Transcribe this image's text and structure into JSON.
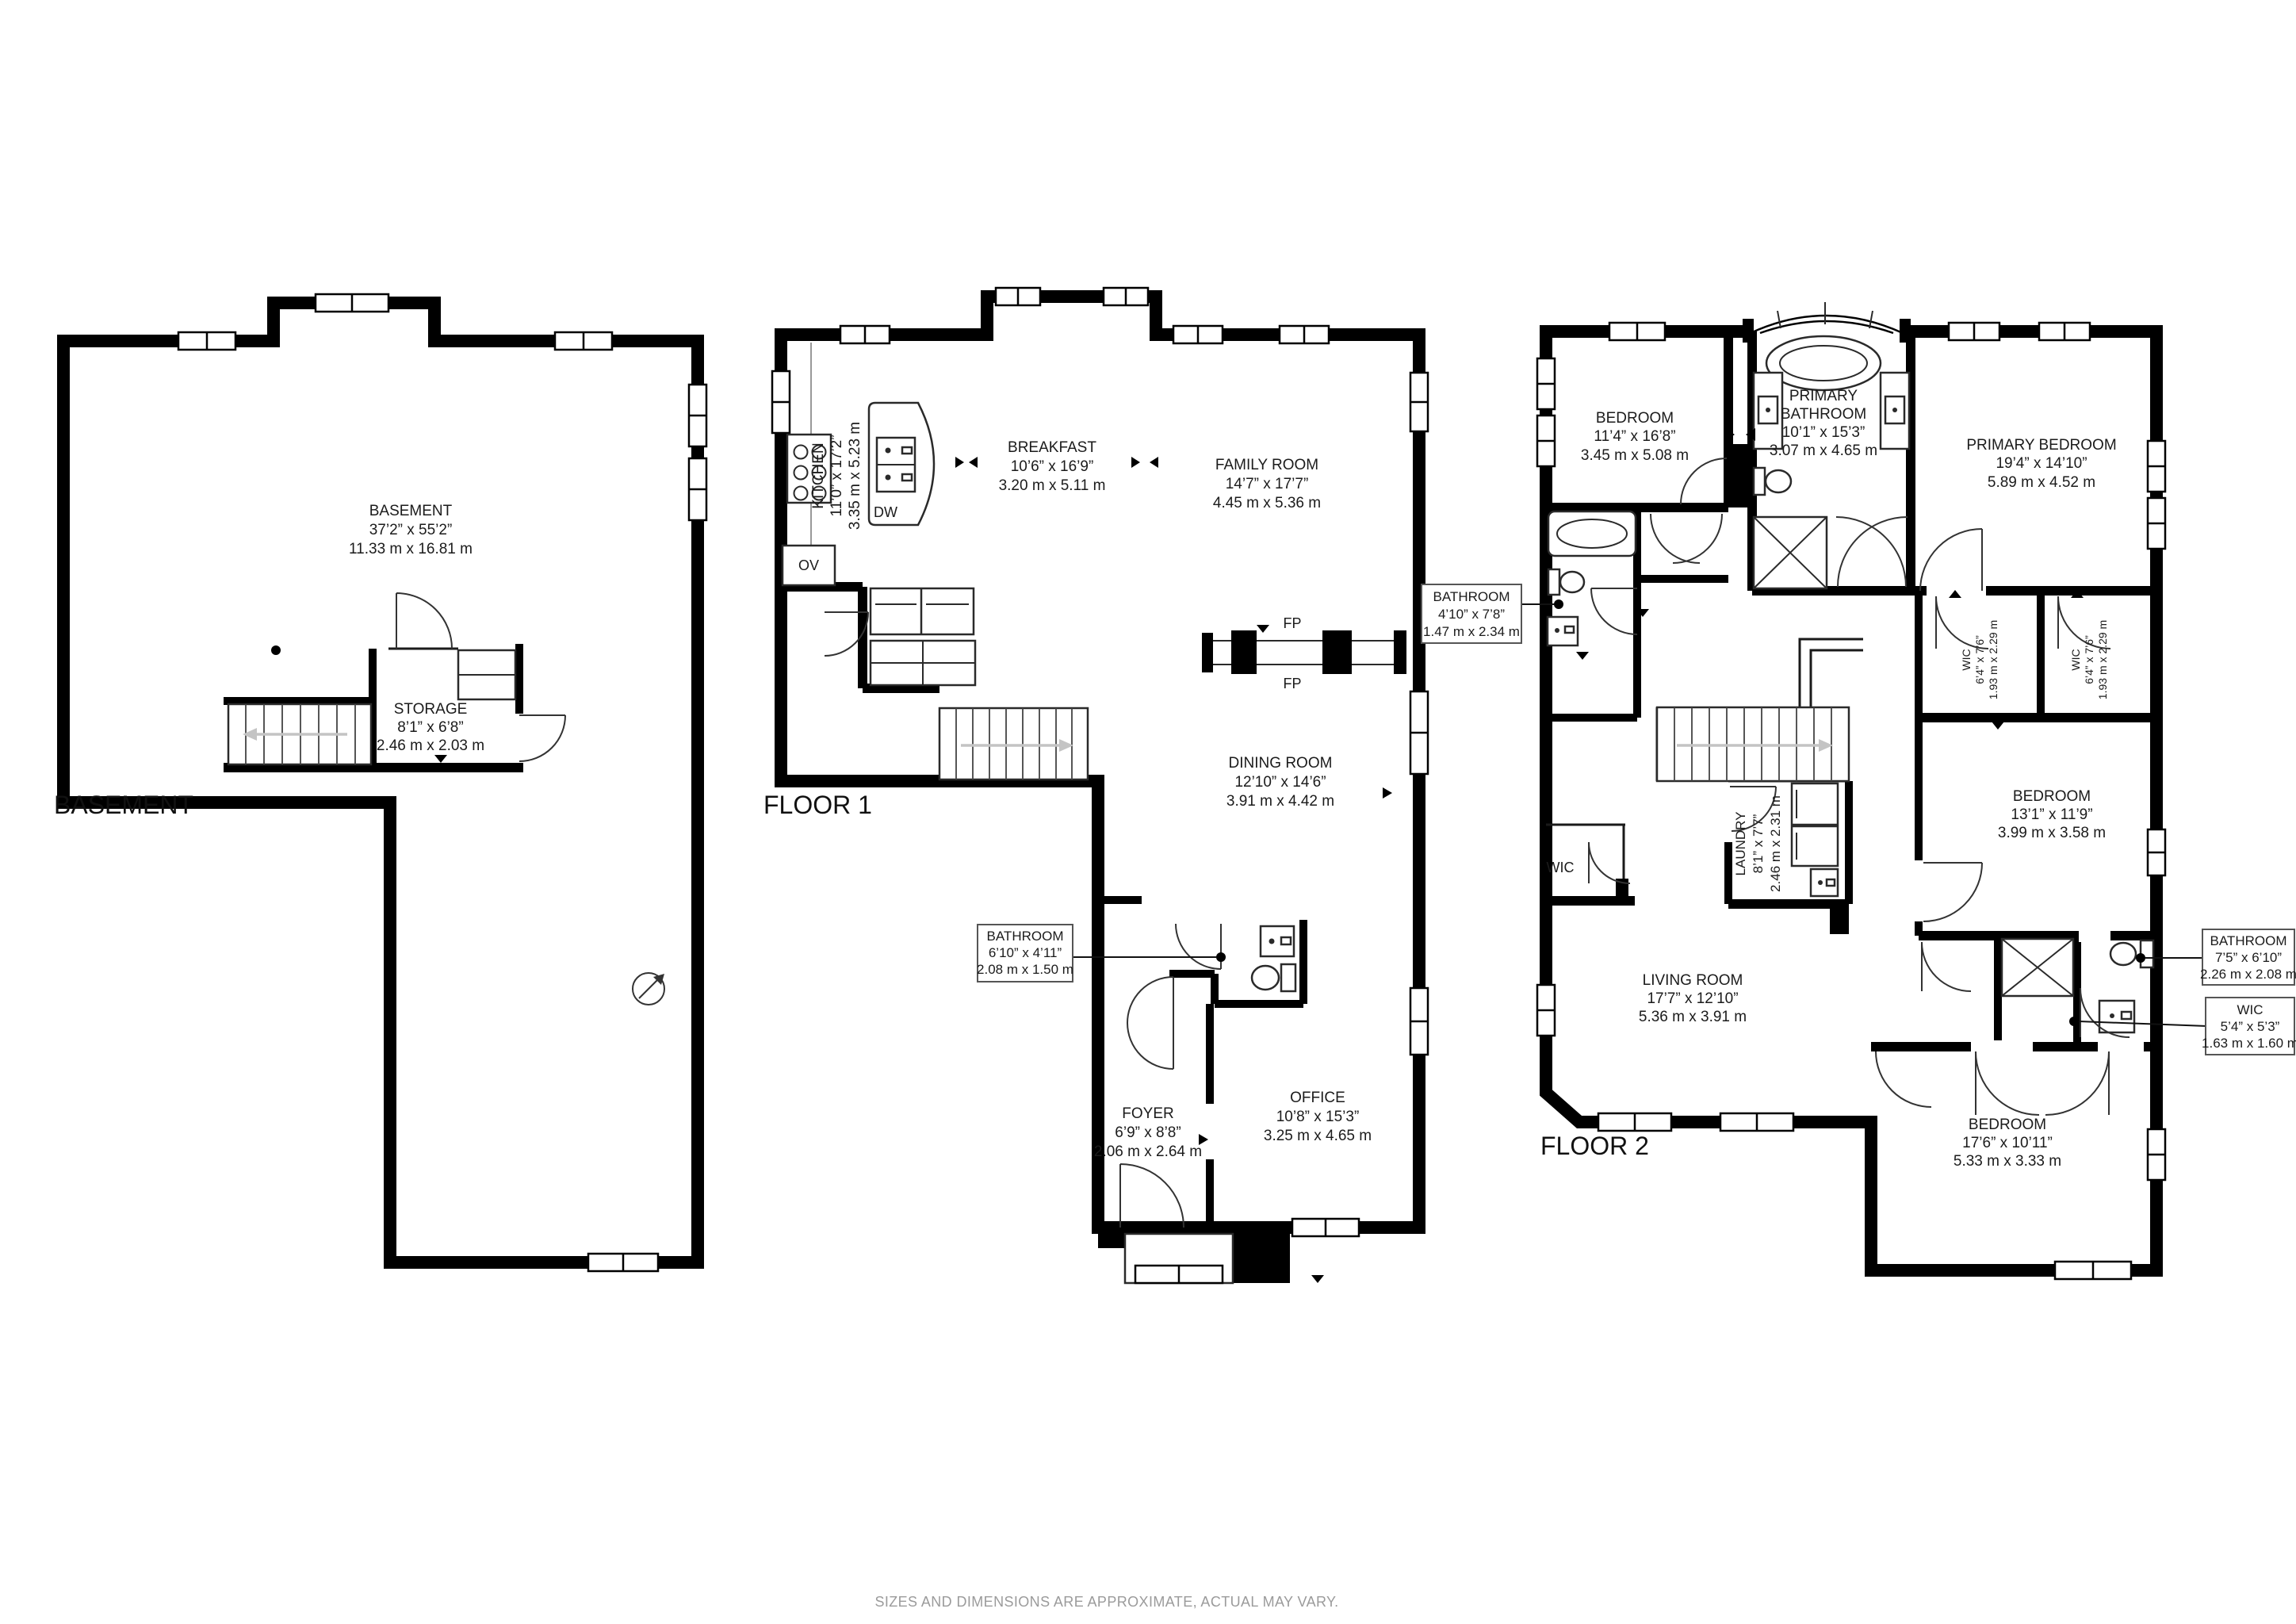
{
  "page": {
    "footer_disclaimer": "SIZES AND DIMENSIONS ARE APPROXIMATE, ACTUAL MAY VARY."
  },
  "colors": {
    "wall": "#000000",
    "text": "#1b1b1b",
    "muted_text": "#9b9b9b",
    "stair_arrow": "#c4c4c4"
  },
  "basement": {
    "title": "BASEMENT",
    "room": {
      "name": "BASEMENT",
      "imperial": "37’2” x 55’2”",
      "metric": "11.33 m x 16.81 m"
    },
    "storage": {
      "name": "STORAGE",
      "imperial": "8’1” x 6’8”",
      "metric": "2.46 m x 2.03 m"
    }
  },
  "floor1": {
    "title": "FLOOR 1",
    "kitchen": {
      "name": "KITCHEN",
      "imperial": "11’0” x 17’2”",
      "metric": "3.35 m x 5.23 m"
    },
    "breakfast": {
      "name": "BREAKFAST",
      "imperial": "10’6” x 16’9”",
      "metric": "3.20 m x 5.11 m"
    },
    "family_room": {
      "name": "FAMILY ROOM",
      "imperial": "14’7” x 17’7”",
      "metric": "4.45 m x 5.36 m"
    },
    "dining_room": {
      "name": "DINING ROOM",
      "imperial": "12’10” x 14’6”",
      "metric": "3.91 m x 4.42 m"
    },
    "bathroom": {
      "name": "BATHROOM",
      "imperial": "6’10” x 4’11”",
      "metric": "2.08 m x 1.50 m"
    },
    "foyer": {
      "name": "FOYER",
      "imperial": "6’9” x 8’8”",
      "metric": "2.06 m x 2.64 m"
    },
    "office": {
      "name": "OFFICE",
      "imperial": "10’8” x 15’3”",
      "metric": "3.25 m x 4.65 m"
    },
    "fixtures": {
      "dishwasher": "DW",
      "oven": "OV",
      "fireplace": "FP"
    }
  },
  "floor2": {
    "title": "FLOOR 2",
    "bedroom_top": {
      "name": "BEDROOM",
      "imperial": "11’4” x 16’8”",
      "metric": "3.45 m x 5.08 m"
    },
    "primary_bathroom": {
      "name_line1": "PRIMARY",
      "name_line2": "BATHROOM",
      "imperial": "10’1” x 15’3”",
      "metric": "3.07 m x 4.65 m"
    },
    "primary_bedroom": {
      "name": "PRIMARY BEDROOM",
      "imperial": "19’4” x 14’10”",
      "metric": "5.89 m x 4.52 m"
    },
    "bathroom_left": {
      "name": "BATHROOM",
      "imperial": "4’10” x 7’8”",
      "metric": "1.47 m x 2.34 m"
    },
    "wic_a": {
      "name": "WIC",
      "imperial": "6’4” x 7’6”",
      "metric": "1.93 m x 2.29 m"
    },
    "wic_b": {
      "name": "WIC",
      "imperial": "6’4” x 7’6”",
      "metric": "1.93 m x 2.29 m"
    },
    "bedroom_mid": {
      "name": "BEDROOM",
      "imperial": "13’1” x 11’9”",
      "metric": "3.99 m x 3.58 m"
    },
    "laundry": {
      "name": "LAUNDRY",
      "imperial": "8’1” x 7’7”",
      "metric": "2.46 m x 2.31 m"
    },
    "wic_small": {
      "name": "WIC"
    },
    "living_room": {
      "name": "LIVING ROOM",
      "imperial": "17’7” x 12’10”",
      "metric": "5.36 m x 3.91 m"
    },
    "bathroom_right": {
      "name": "BATHROOM",
      "imperial": "7’5” x 6’10”",
      "metric": "2.26 m x 2.08 m"
    },
    "wic_callout": {
      "name": "WIC",
      "imperial": "5’4” x 5’3”",
      "metric": "1.63 m x 1.60 m"
    },
    "bedroom_bottom": {
      "name": "BEDROOM",
      "imperial": "17’6” x 10’11”",
      "metric": "5.33 m x 3.33 m"
    }
  }
}
